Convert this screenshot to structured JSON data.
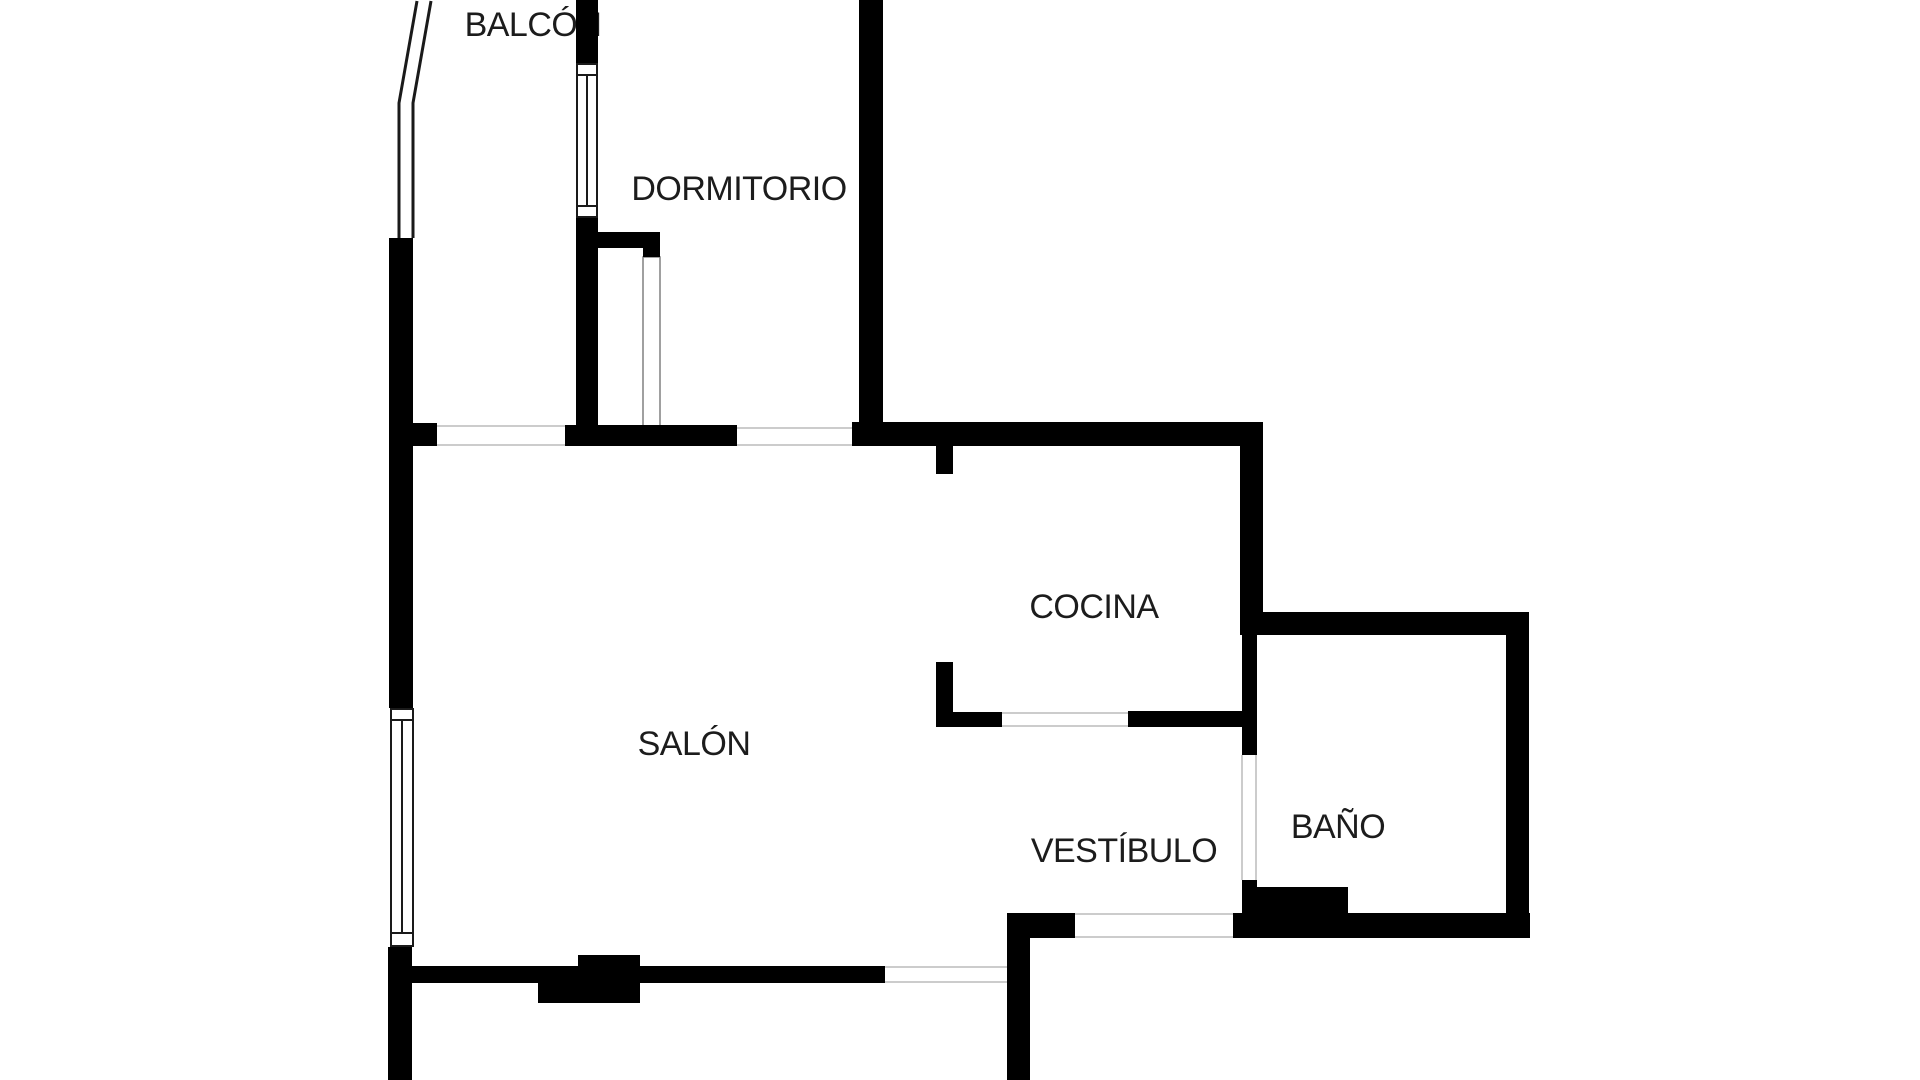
{
  "title": "Floor plan",
  "colors": {
    "background": "#ffffff",
    "wall": "#000000",
    "opening_line": "#cccccc",
    "window_frame": "#1a1a1a",
    "door_leaf_border": "#808080",
    "label_text": "#1c1c1c"
  },
  "rooms": [
    {
      "id": "balcon",
      "label": "BALCÓN",
      "cx": 533,
      "cy": 25
    },
    {
      "id": "dormitorio",
      "label": "DORMITORIO",
      "cx": 739,
      "cy": 189
    },
    {
      "id": "cocina",
      "label": "COCINA",
      "cx": 1094,
      "cy": 607
    },
    {
      "id": "salon",
      "label": "SALÓN",
      "cx": 694,
      "cy": 744
    },
    {
      "id": "vestibulo",
      "label": "VESTÍBULO",
      "cx": 1124,
      "cy": 851
    },
    {
      "id": "bano",
      "label": "BAÑO",
      "cx": 1338,
      "cy": 827
    }
  ],
  "walls": [
    {
      "name": "left-wall-upper",
      "x": 389,
      "y": 238,
      "w": 24,
      "h": 470
    },
    {
      "name": "left-wall-lower",
      "x": 388,
      "y": 947,
      "w": 24,
      "h": 133
    },
    {
      "name": "left-wall-door-stub",
      "x": 389,
      "y": 423,
      "w": 48,
      "h": 23
    },
    {
      "name": "salon-dormitorio-wall",
      "x": 565,
      "y": 425,
      "w": 172,
      "h": 21
    },
    {
      "name": "dormitorio-left-wall-top",
      "x": 576,
      "y": 0,
      "w": 22,
      "h": 63
    },
    {
      "name": "dormitorio-left-wall",
      "x": 576,
      "y": 218,
      "w": 22,
      "h": 228
    },
    {
      "name": "dormitorio-door-stub",
      "x": 598,
      "y": 232,
      "w": 62,
      "h": 16
    },
    {
      "name": "dormitorio-door-jamb",
      "x": 643,
      "y": 232,
      "w": 17,
      "h": 25
    },
    {
      "name": "dormitorio-right-wall",
      "x": 859,
      "y": 0,
      "w": 24,
      "h": 446
    },
    {
      "name": "cocina-top-wall",
      "x": 852,
      "y": 422,
      "w": 411,
      "h": 24
    },
    {
      "name": "cocina-door-stub-upper",
      "x": 936,
      "y": 446,
      "w": 17,
      "h": 28
    },
    {
      "name": "cocina-stub-vertical",
      "x": 936,
      "y": 662,
      "w": 17,
      "h": 65
    },
    {
      "name": "cocina-stub-horizontal",
      "x": 936,
      "y": 712,
      "w": 66,
      "h": 15
    },
    {
      "name": "vestibulo-cocina-wall",
      "x": 1128,
      "y": 711,
      "w": 129,
      "h": 16
    },
    {
      "name": "cocina-bano-wall",
      "x": 1240,
      "y": 446,
      "w": 23,
      "h": 189
    },
    {
      "name": "bano-top-wall",
      "x": 1263,
      "y": 612,
      "w": 266,
      "h": 23
    },
    {
      "name": "bano-left-wall",
      "x": 1242,
      "y": 635,
      "w": 15,
      "h": 120
    },
    {
      "name": "bano-left-jamb",
      "x": 1242,
      "y": 880,
      "w": 15,
      "h": 33
    },
    {
      "name": "bano-corner-block",
      "x": 1242,
      "y": 887,
      "w": 106,
      "h": 26
    },
    {
      "name": "bano-bottom-wall",
      "x": 1233,
      "y": 913,
      "w": 297,
      "h": 25
    },
    {
      "name": "bano-right-wall",
      "x": 1506,
      "y": 612,
      "w": 23,
      "h": 326
    },
    {
      "name": "salon-bottom-wall",
      "x": 405,
      "y": 966,
      "w": 480,
      "h": 17
    },
    {
      "name": "salon-pillar-top",
      "x": 578,
      "y": 955,
      "w": 62,
      "h": 13
    },
    {
      "name": "salon-pillar-bottom",
      "x": 538,
      "y": 983,
      "w": 102,
      "h": 20
    },
    {
      "name": "vestibulo-left-wall",
      "x": 1007,
      "y": 913,
      "w": 23,
      "h": 167
    },
    {
      "name": "vestibulo-bottom-wall",
      "x": 1007,
      "y": 913,
      "w": 68,
      "h": 25
    }
  ],
  "opening_lines": [
    {
      "name": "balcony-door-opening",
      "x1": 437,
      "y1": 426,
      "x2": 565,
      "y2": 426
    },
    {
      "name": "balcony-door-opening",
      "x1": 437,
      "y1": 445,
      "x2": 565,
      "y2": 445
    },
    {
      "name": "hall-opening",
      "x1": 737,
      "y1": 428,
      "x2": 852,
      "y2": 428
    },
    {
      "name": "hall-opening",
      "x1": 737,
      "y1": 445,
      "x2": 852,
      "y2": 445
    },
    {
      "name": "cocina-opening",
      "x1": 1002,
      "y1": 713,
      "x2": 1128,
      "y2": 713
    },
    {
      "name": "cocina-opening",
      "x1": 1002,
      "y1": 726,
      "x2": 1128,
      "y2": 726
    },
    {
      "name": "salon-vestibulo-opening",
      "x1": 885,
      "y1": 967,
      "x2": 1007,
      "y2": 967
    },
    {
      "name": "salon-vestibulo-opening",
      "x1": 885,
      "y1": 982,
      "x2": 1007,
      "y2": 982
    },
    {
      "name": "entry-opening",
      "x1": 1075,
      "y1": 914,
      "x2": 1233,
      "y2": 914
    },
    {
      "name": "entry-opening",
      "x1": 1075,
      "y1": 937,
      "x2": 1233,
      "y2": 937
    },
    {
      "name": "bano-door-opening",
      "x1": 1242,
      "y1": 755,
      "x2": 1242,
      "y2": 880
    },
    {
      "name": "bano-door-opening",
      "x1": 1256,
      "y1": 755,
      "x2": 1256,
      "y2": 880
    }
  ],
  "windows": [
    {
      "name": "dormitorio-window",
      "x": 576,
      "y": 63,
      "w": 22,
      "h": 155,
      "div1": 75,
      "div2": 206,
      "mullion": 587
    },
    {
      "name": "salon-window",
      "x": 390,
      "y": 708,
      "w": 24,
      "h": 239,
      "div1": 720,
      "div2": 933,
      "mullion": 402
    }
  ],
  "railing": [
    {
      "name": "balcony-railing-outer",
      "points": "417,1 399,103 399,238"
    },
    {
      "name": "balcony-railing-inner",
      "points": "431,1 413,103 413,238"
    }
  ],
  "door_leaves": [
    {
      "name": "dormitorio-door-leaf",
      "x": 643,
      "y": 257,
      "w": 17,
      "h": 172
    }
  ]
}
